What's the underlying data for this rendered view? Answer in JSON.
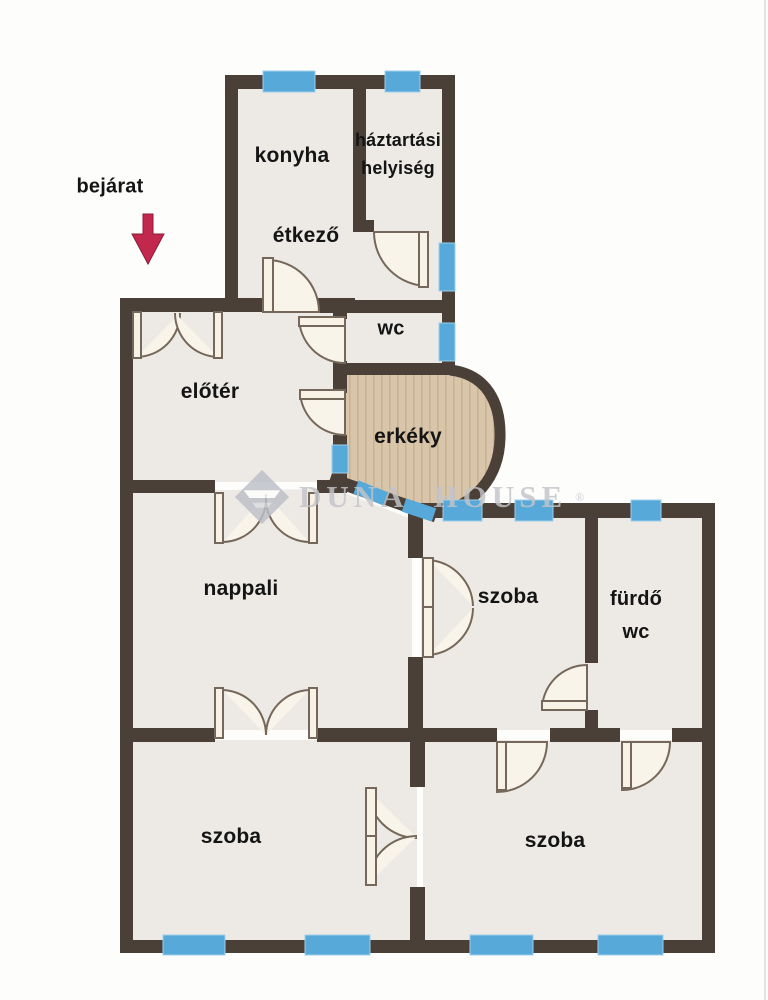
{
  "plan": {
    "entrance_label": "bejárat",
    "rooms": [
      {
        "id": "konyha",
        "label": "konyha"
      },
      {
        "id": "haztartasi",
        "label": "háztartási",
        "label2": "helyiség"
      },
      {
        "id": "etkezo",
        "label": "étkező"
      },
      {
        "id": "wc",
        "label": "wc"
      },
      {
        "id": "eloter",
        "label": "előtér"
      },
      {
        "id": "erkely",
        "label": "erkéky"
      },
      {
        "id": "nappali",
        "label": "nappali"
      },
      {
        "id": "szoba_kozep",
        "label": "szoba"
      },
      {
        "id": "furdo",
        "label": "fürdő",
        "label2": "wc"
      },
      {
        "id": "szoba_bal",
        "label": "szoba"
      },
      {
        "id": "szoba_jobb",
        "label": "szoba"
      }
    ],
    "watermark": {
      "brand": "Duna House",
      "display": "DUNA HOUSE",
      "registered": "®"
    },
    "colors": {
      "wall": "#4b4037",
      "floor": "#edeae6",
      "window": "#57a9d9",
      "balcony_floor": "#d9c5a9",
      "door_leaf": "#f7f1e6",
      "door_line": "#75685a",
      "arrow": "#c2274d",
      "watermark": "#c3c4ca",
      "label_text": "#141414"
    }
  }
}
